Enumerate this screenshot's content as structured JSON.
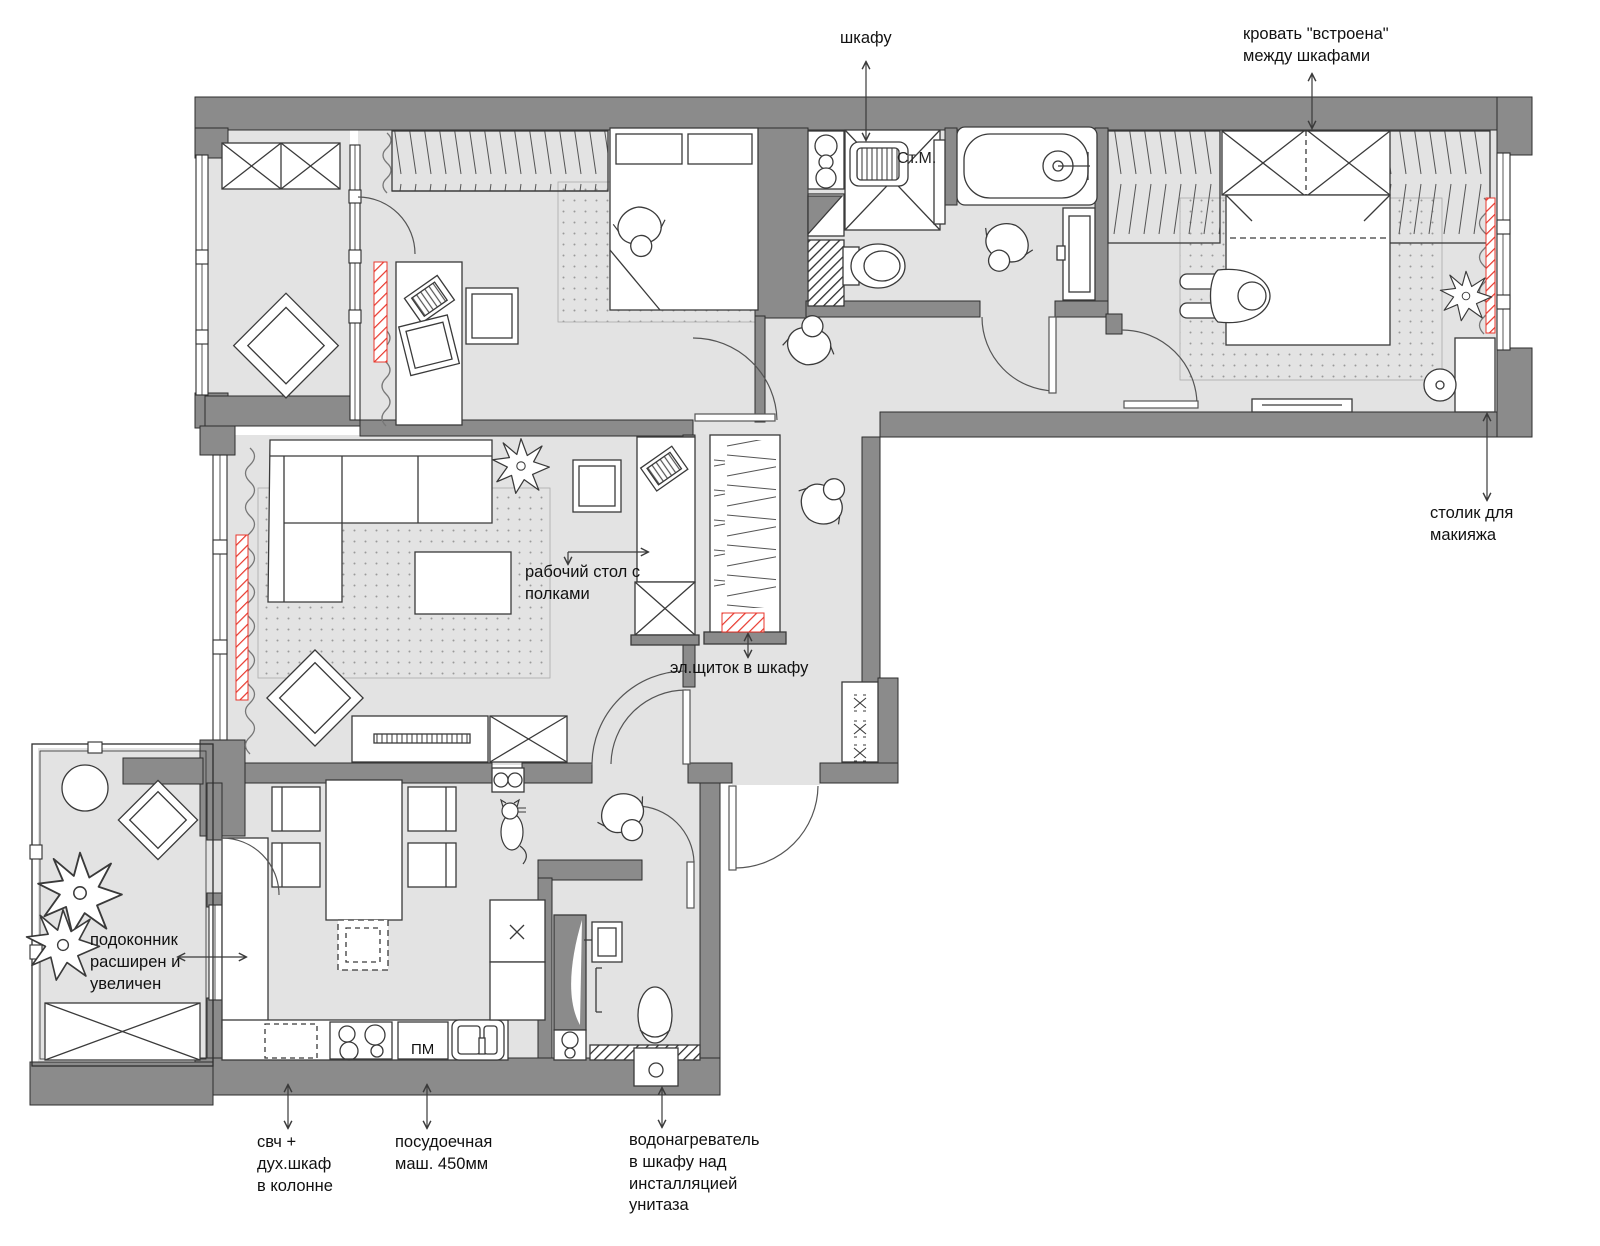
{
  "colors": {
    "wall": "#8b8b8b",
    "floor": "#e3e3e3",
    "accent_red": "#e8372c",
    "line": "#3a3a3a",
    "background": "#ffffff"
  },
  "plan_labels": {
    "washing_machine": "Ст.М.",
    "dishwasher": "ПМ"
  },
  "annotations": [
    {
      "id": "wardrobe-top",
      "text": "шкафу"
    },
    {
      "id": "built-in-bed",
      "text": "кровать \"встроена\"\nмежду шкафами"
    },
    {
      "id": "makeup-table",
      "text": "столик для\nмакияжа"
    },
    {
      "id": "work-desk",
      "text": "рабочий стол с\nполками"
    },
    {
      "id": "electrical-panel",
      "text": "эл.щиток в шкафу"
    },
    {
      "id": "windowsill",
      "text": "подоконник\nрасширен и\nувеличен"
    },
    {
      "id": "microwave-oven",
      "text": "свч +\nдух.шкаф\nв колонне"
    },
    {
      "id": "dishwasher-450",
      "text": "посудоечная\nмаш. 450мм"
    },
    {
      "id": "water-heater",
      "text": "водонагреватель\nв шкафу над\nинсталляцией\nунитаза"
    }
  ]
}
